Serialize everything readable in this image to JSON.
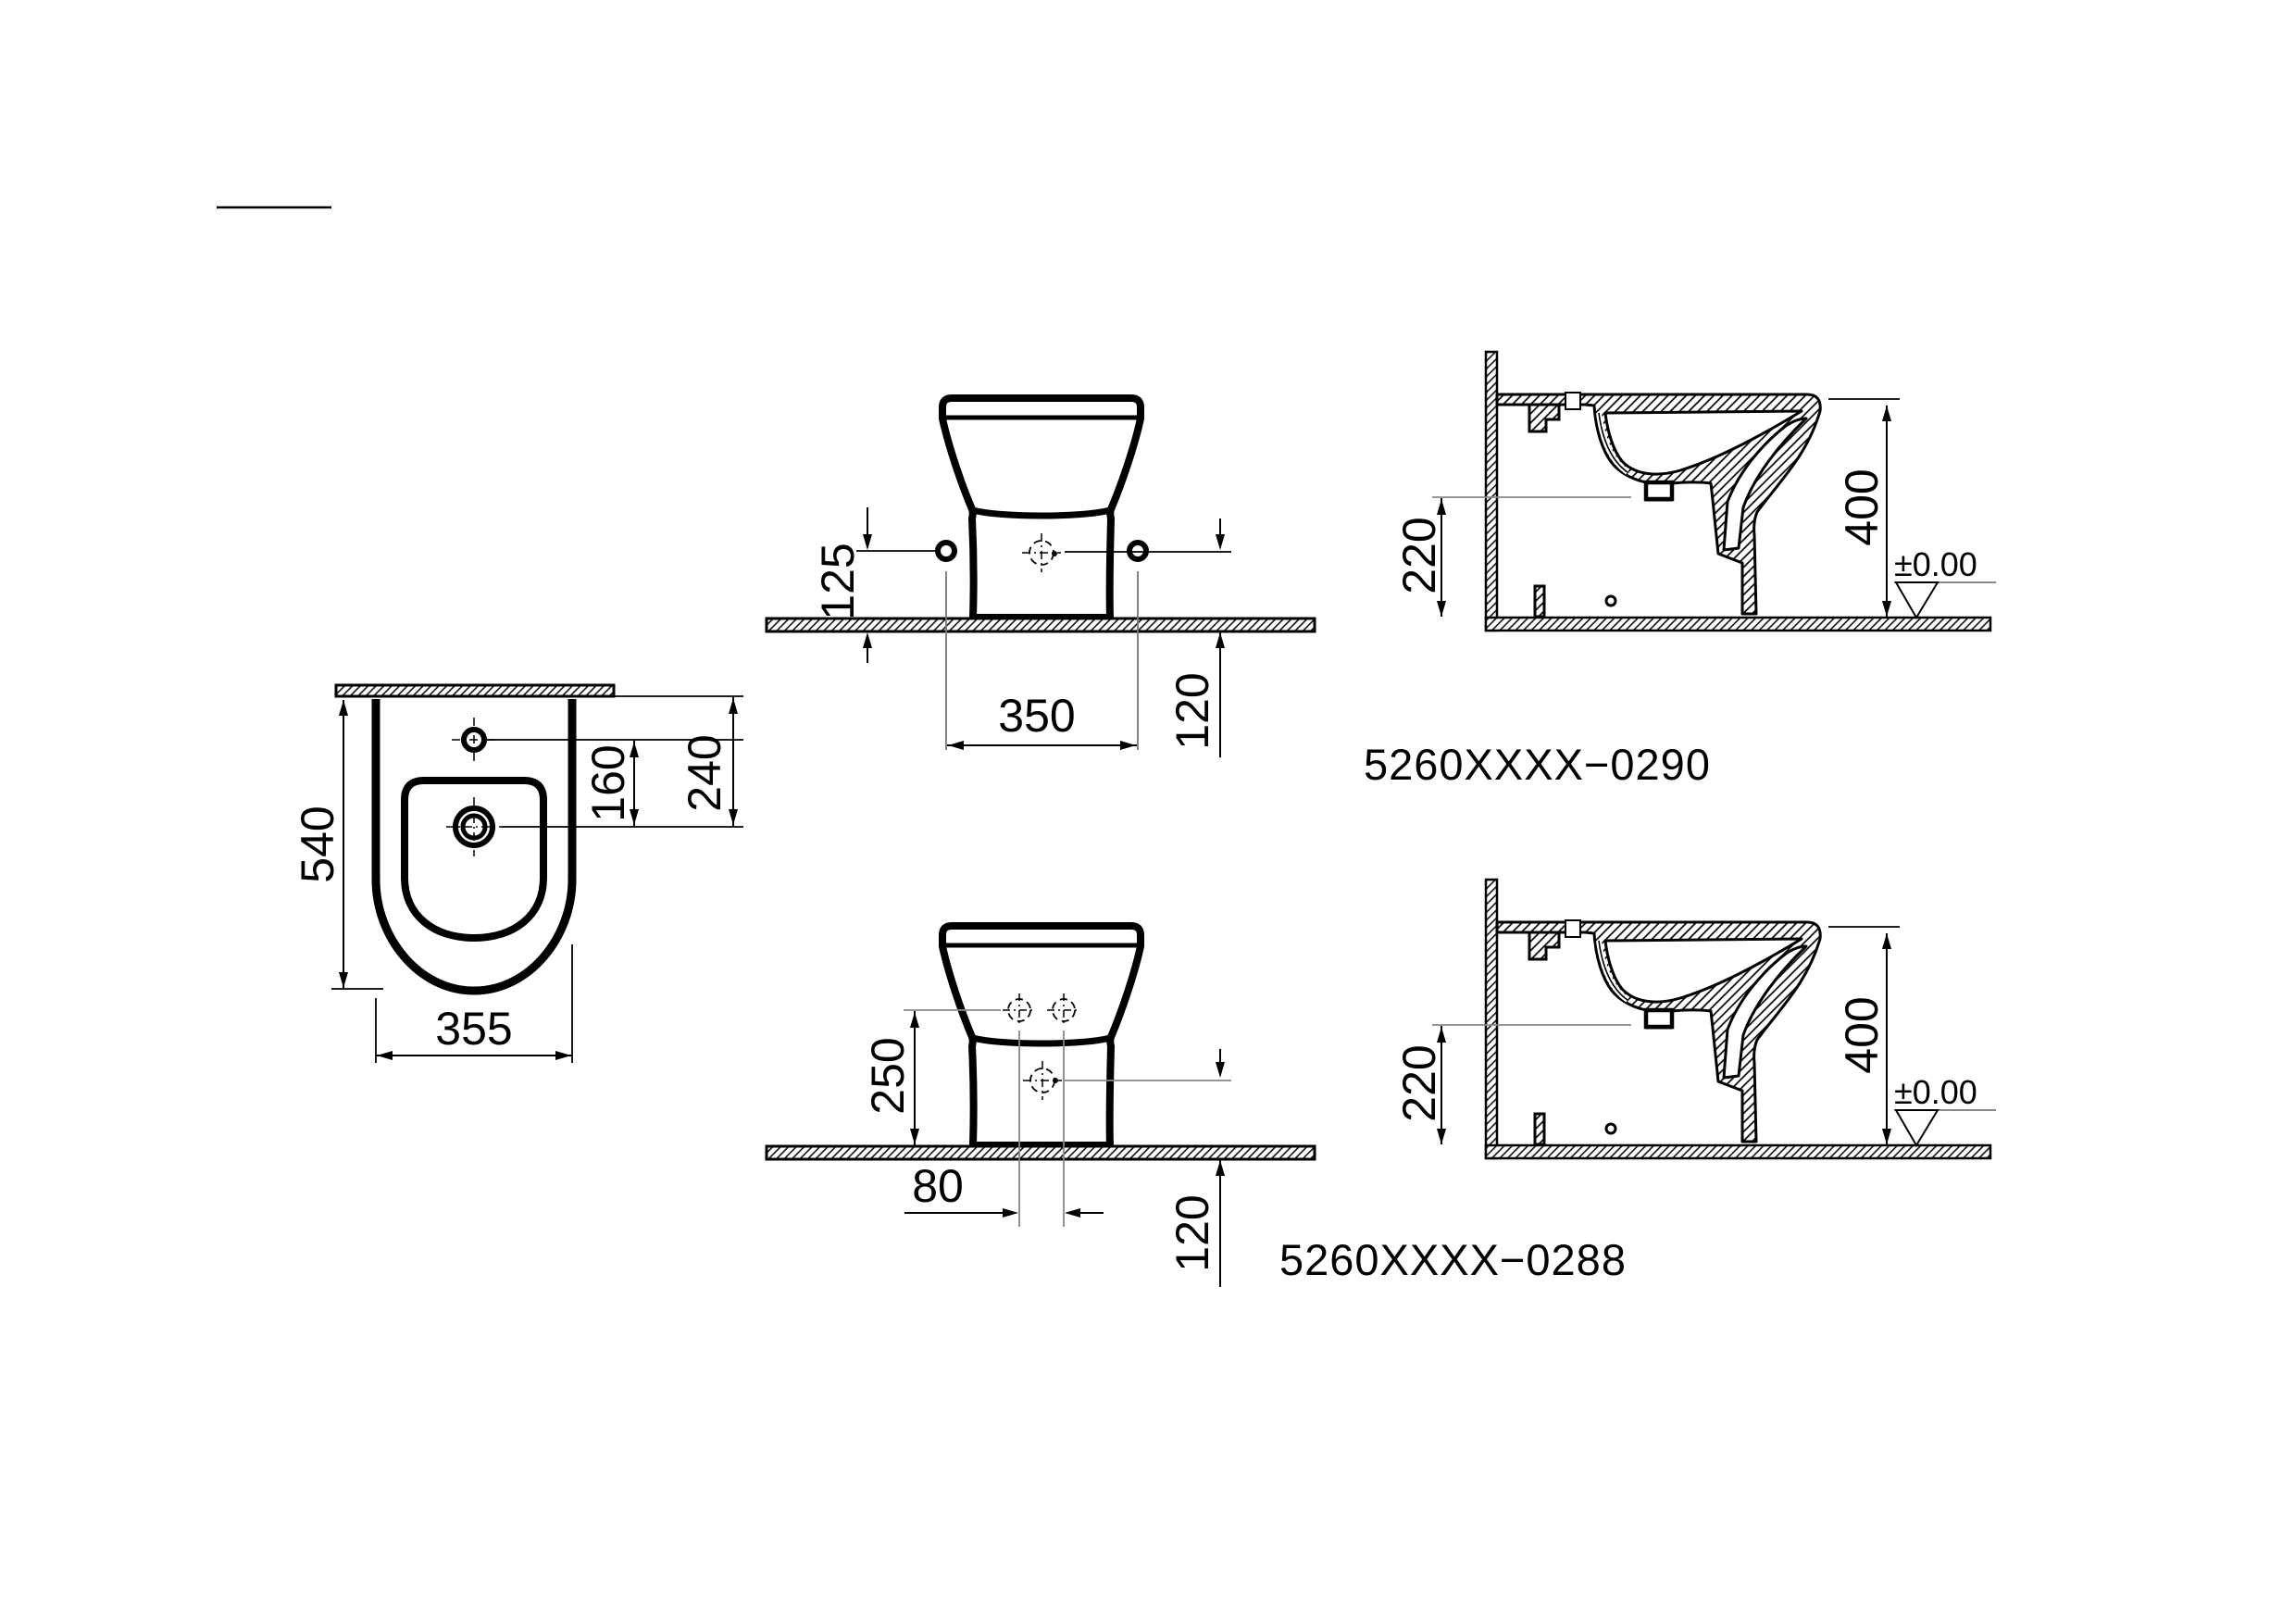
{
  "codes": {
    "v0290": "5260XXXX−0290",
    "v0288": "5260XXXX−0288"
  },
  "plan": {
    "depth": "540",
    "width": "355",
    "tap_to_hole": "160",
    "wall_to_tap": "240"
  },
  "front0290": {
    "hole_height": "125",
    "hole_spacing": "350",
    "below_floor": "120"
  },
  "front0288": {
    "hole_height": "250",
    "hole_spacing": "80",
    "below_floor": "120"
  },
  "section": {
    "height": "400",
    "rim_to_inlet": "220",
    "floor_level": "±0.00"
  },
  "colors": {
    "line": "#000000",
    "aux": "#888888",
    "background": "#ffffff"
  }
}
